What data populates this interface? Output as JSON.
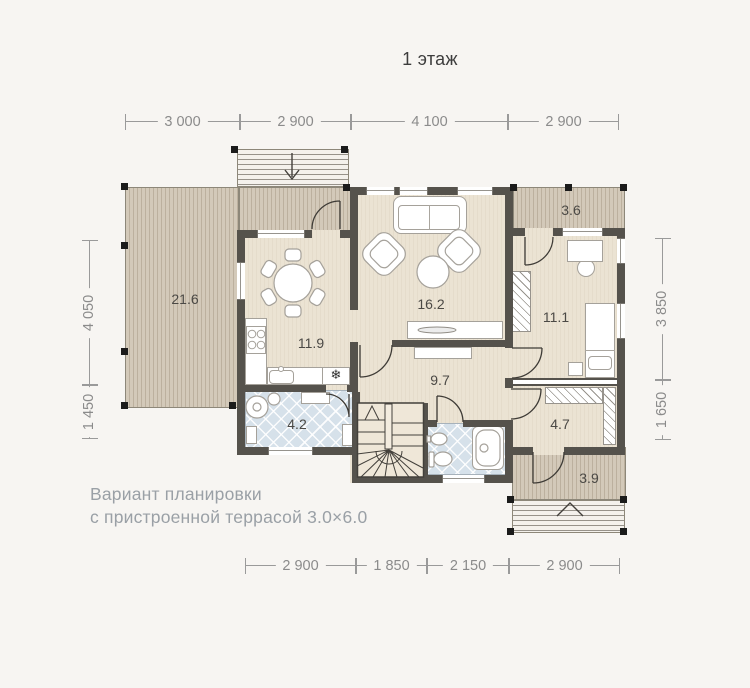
{
  "title": "1 этаж",
  "caption": {
    "line1": "Вариант планировки",
    "line2": "с пристроенной террасой 3.0×6.0"
  },
  "rooms": {
    "terrace": "21.6",
    "living": "16.2",
    "kitchen": "11.9",
    "bedroom": "11.1",
    "hall": "9.7",
    "bathroom": "4.2",
    "entry": "4.7",
    "balcony": "3.6",
    "porch": "3.9"
  },
  "dimensions": {
    "top": [
      "3 000",
      "2 900",
      "4 100",
      "2 900"
    ],
    "bottom": [
      "2 900",
      "1 850",
      "2 150",
      "2 900"
    ],
    "left": [
      "4 050",
      "1 450"
    ],
    "right": [
      "3 850",
      "1 650"
    ]
  },
  "icons": {
    "fridge_snowflake": "❄"
  },
  "colors": {
    "background": "#f7f5f2",
    "wall": "#55524c",
    "floor": "#ebe3d3",
    "deck": "#d3c9b9",
    "tile": "#d6e1ea",
    "dimension": "#8b8b8b",
    "room_label": "#4b4945",
    "caption": "#9aa0a6"
  }
}
